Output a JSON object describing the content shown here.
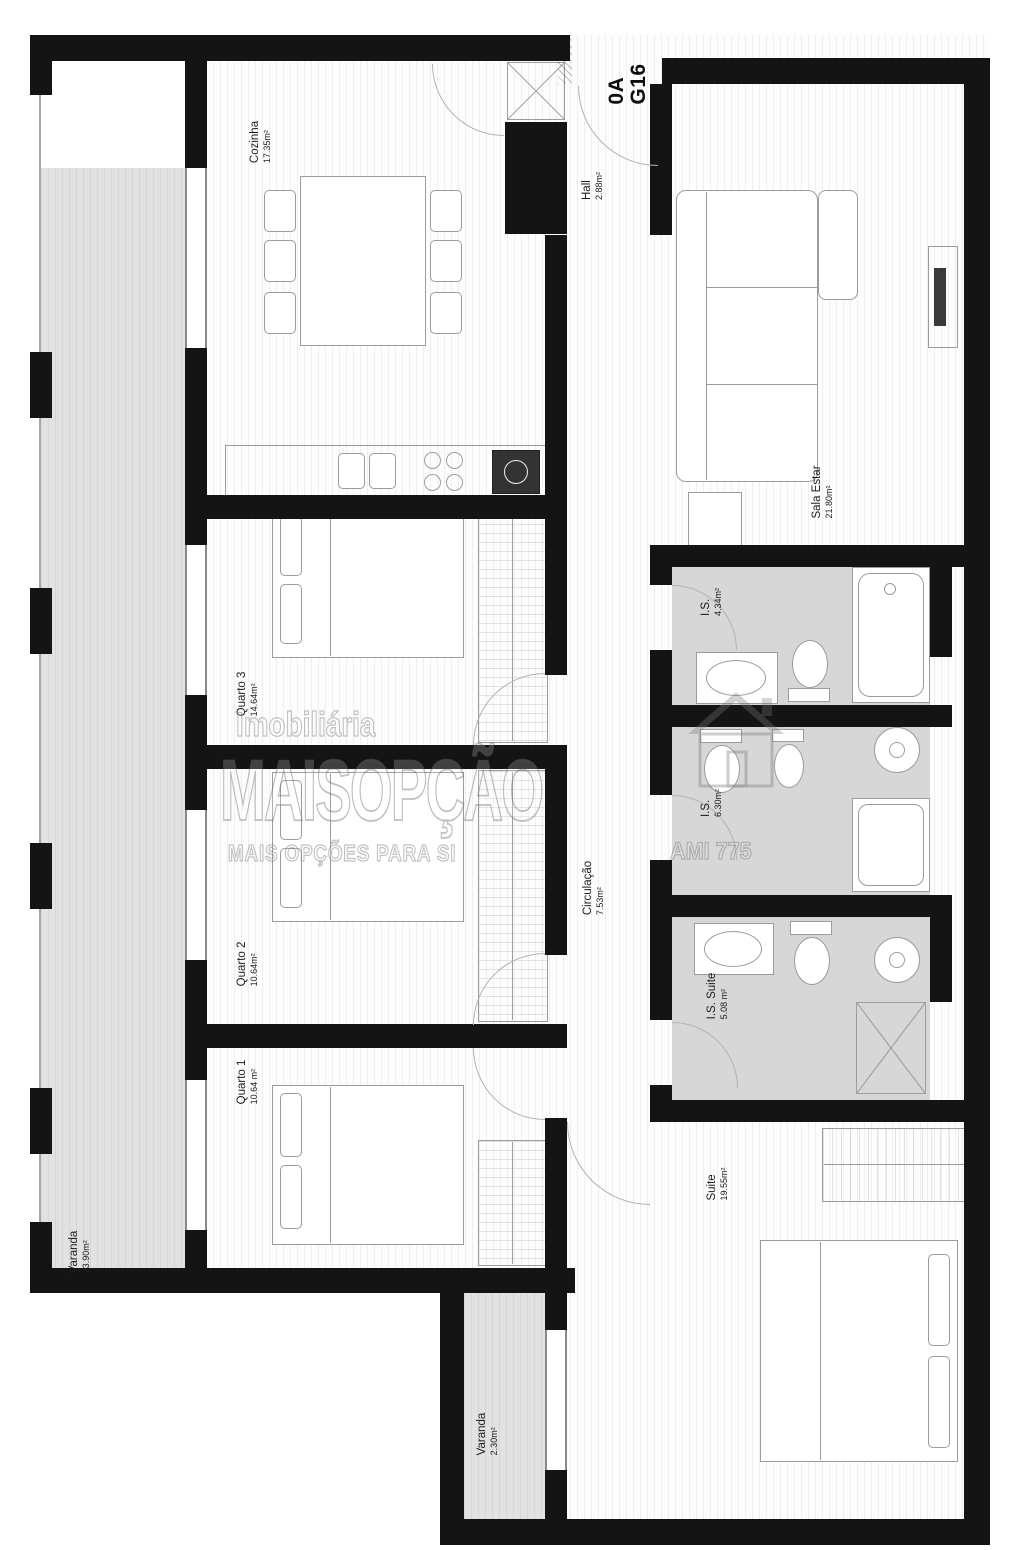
{
  "plan": {
    "unit_label": {
      "line1": "0A",
      "line2": "G16"
    },
    "rooms": [
      {
        "id": "cozinha",
        "name": "Cozinha",
        "area": "17.35m²"
      },
      {
        "id": "hall",
        "name": "Hall",
        "area": "2.88m²"
      },
      {
        "id": "sala-estar",
        "name": "Sala Estar",
        "area": "21.80m²"
      },
      {
        "id": "varanda-1",
        "name": "Varanda",
        "area": "23.90m²"
      },
      {
        "id": "quarto-3",
        "name": "Quarto 3",
        "area": "14.64m²"
      },
      {
        "id": "quarto-2",
        "name": "Quarto 2",
        "area": "10.64m²"
      },
      {
        "id": "quarto-1",
        "name": "Quarto 1",
        "area": "10.64 m²"
      },
      {
        "id": "circulacao",
        "name": "Circulação",
        "area": "7.53m²"
      },
      {
        "id": "is-1",
        "name": "I.S.",
        "area": "4.34m²"
      },
      {
        "id": "is-2",
        "name": "I.S.",
        "area": "6.30m²"
      },
      {
        "id": "is-suite",
        "name": "I.S. Suite",
        "area": "5.08 m²"
      },
      {
        "id": "suite",
        "name": "Suite",
        "area": "19.55m²"
      },
      {
        "id": "varanda-2",
        "name": "Varanda",
        "area": "2.30m²"
      }
    ],
    "watermark": {
      "brand_top": "Imobiliária",
      "brand_main": "MAISOPÇÃO",
      "tagline": "MAIS OPÇÕES PARA SI",
      "license": "AMI 775"
    },
    "colors": {
      "wall": "#141414",
      "balcony_fill": "#e2e2e2",
      "bathroom_fill": "#d7d7d7",
      "furniture_outline": "#9c9c9c",
      "watermark_gray": "#737373"
    }
  }
}
